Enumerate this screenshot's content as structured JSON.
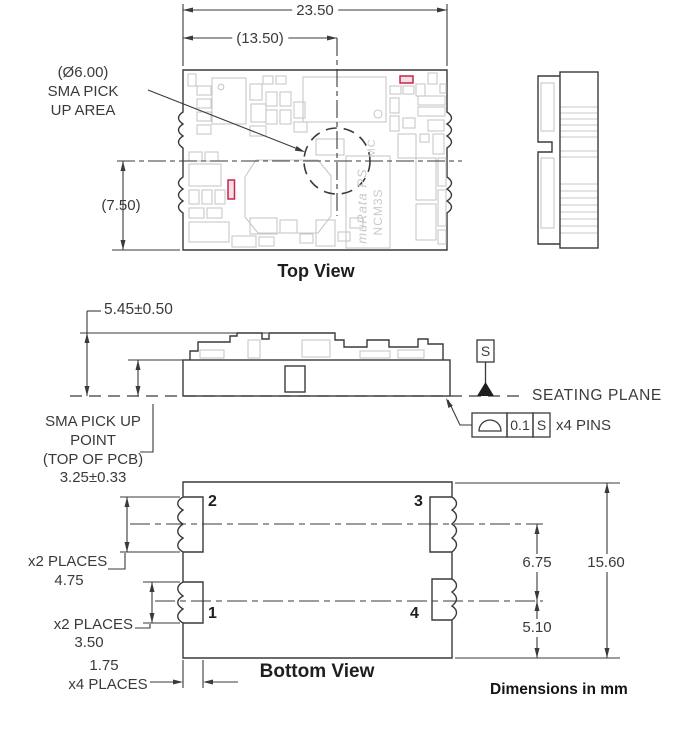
{
  "colors": {
    "line": "#3a3a3a",
    "light_component": "#c8c8c8",
    "highlight_red": "#c9254b"
  },
  "top_view": {
    "title": "Top View",
    "dim_overall_width": "23.50",
    "dim_sma_offset": "(13.50)",
    "dim_center_height": "(7.50)",
    "sma_area_line1": "(Ø6.00)",
    "sma_area_line2": "SMA PICK",
    "sma_area_line3": "UP AREA",
    "pcb_brand": "muRata PS",
    "pcb_model": "NCM3S",
    "pcb_model2": "MC"
  },
  "side_view": {
    "dim_height": "5.45±0.50",
    "seating_plane": "SEATING PLANE",
    "datum_label": "S",
    "fcf_symbol": "profile-of-surface",
    "fcf_tolerance": "0.1",
    "fcf_datum": "S",
    "fcf_note": "x4 PINS",
    "sma_point_line1": "SMA PICK UP",
    "sma_point_line2": "POINT",
    "sma_point_line3": "(TOP OF PCB)",
    "sma_point_line4": "3.25±0.33"
  },
  "bottom_view": {
    "title": "Bottom View",
    "pin_labels": [
      "1",
      "2",
      "3",
      "4"
    ],
    "dim_pin_upper_places": "x2 PLACES",
    "dim_pin_upper": "4.75",
    "dim_pin_lower_places": "x2 PLACES",
    "dim_pin_lower": "3.50",
    "dim_pin_width": "1.75",
    "dim_pin_width_places": "x4 PLACES",
    "dim_pin_pitch": "6.75",
    "dim_length": "15.60",
    "dim_pin_offset": "5.10"
  },
  "footer": "Dimensions in mm"
}
